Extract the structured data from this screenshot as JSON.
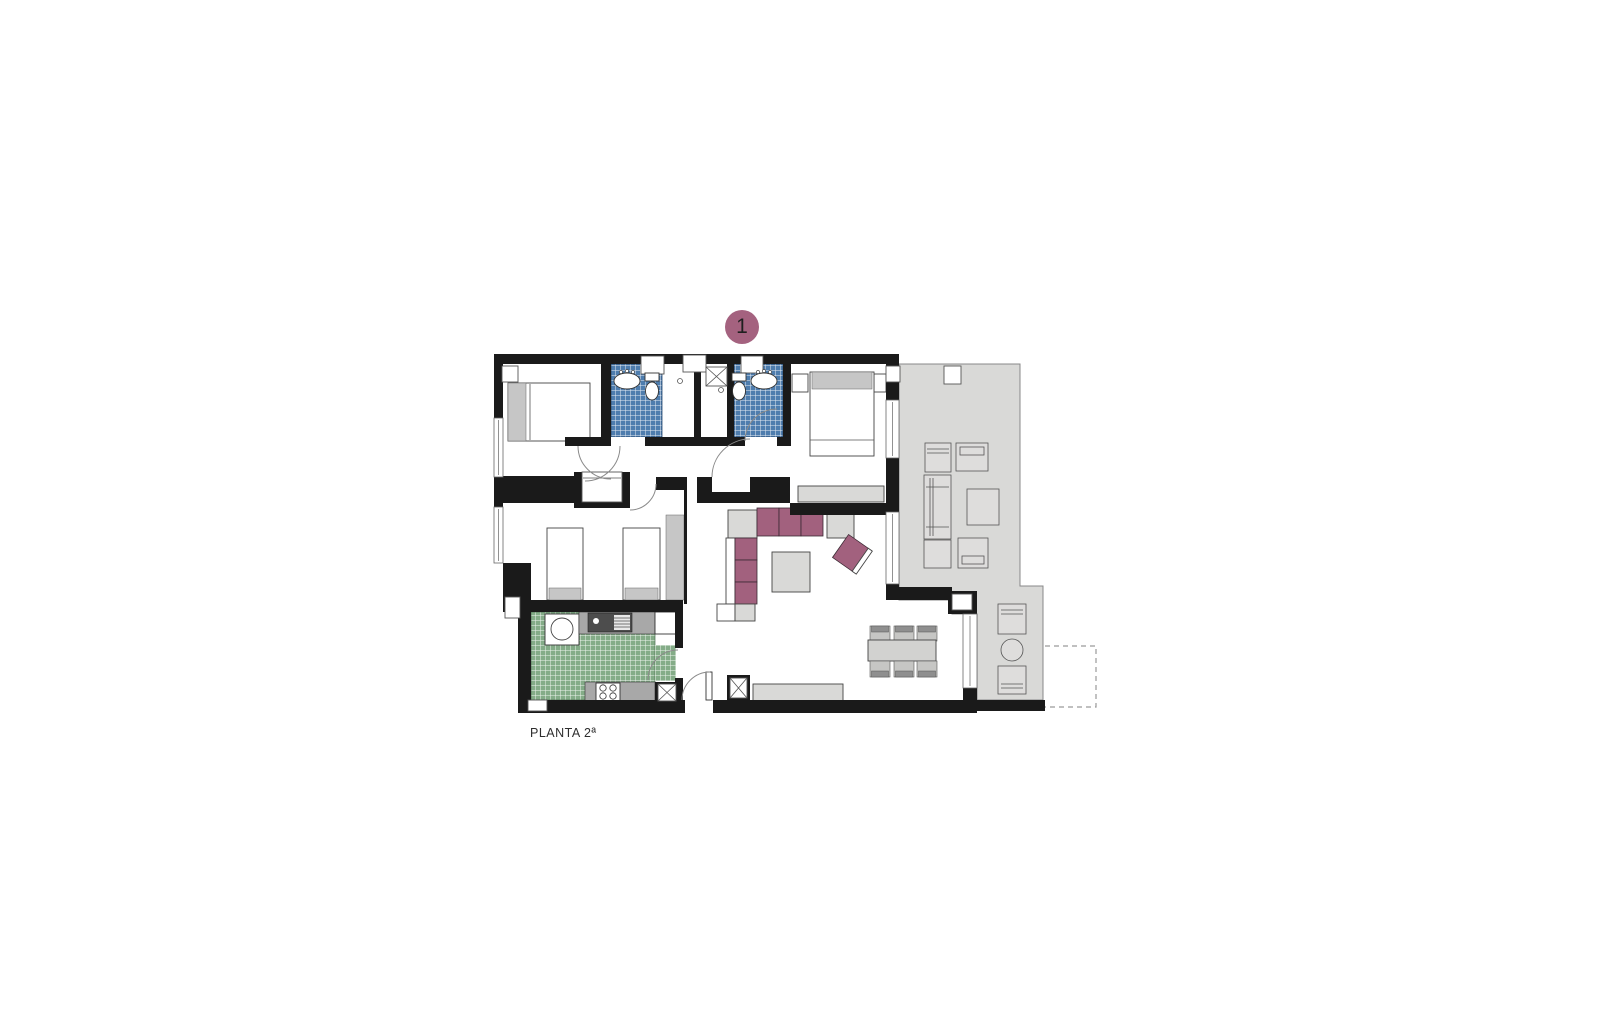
{
  "badge": {
    "unit_number": "1"
  },
  "caption": {
    "floor_label": "PLANTA 2ª"
  },
  "colors": {
    "wall": "#1a1a1a",
    "badge": "#a4627f",
    "sofa": "#a2617e",
    "tile_blue": "#4e7dae",
    "tile_green": "#84ac88",
    "terrace": "#d9d9d7",
    "furn_gray": "#d9d9d7",
    "accent_gray": "#c6c6c6",
    "counter_gray": "#a8a8a8"
  }
}
